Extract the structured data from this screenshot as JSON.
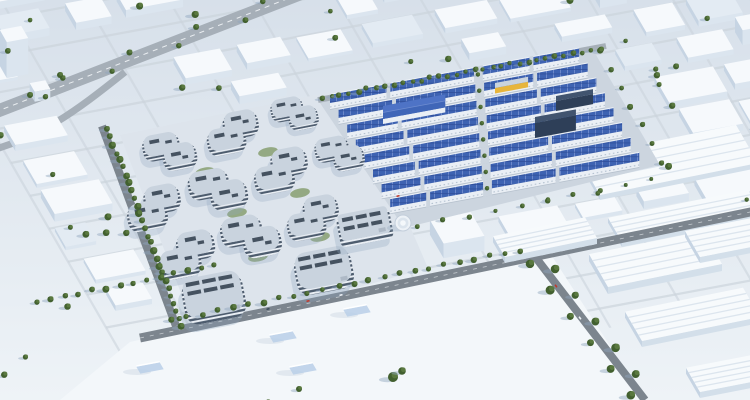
{
  "scene": {
    "label": "Aerial architectural rendering of a business and industrial park: curved terraced office buildings and rows of warehouses with blue rooftop solar panels, surrounded by white low-rise city massing and tree-lined roads",
    "type": "aerial-architectural-rendering",
    "office_campus": {
      "curved_buildings": 10,
      "tower_buildings": 2,
      "slab_buildings": 1,
      "feature": "curved stepped facades with rooftop solar panels"
    },
    "industrial_park": {
      "warehouse_rows": 8,
      "roof_type": "blue photovoltaic panels",
      "landmarks": [
        "large-blue-gable-hall",
        "navy-tower",
        "yellow-facade-unit",
        "round-pavilion"
      ]
    },
    "context": {
      "city_blocks": "white massing model",
      "roads": [
        "elevated-highway-northwest",
        "perimeter-roads",
        "tree-lined-avenue-southeast"
      ],
      "vegetation": "street trees and hedges"
    },
    "colors": {
      "bg_top": "#d7e0ea",
      "bg_bottom": "#eef3f7",
      "street": "#ccd4dc",
      "road_major": "#a6afb8",
      "road_dark": "#7c858e",
      "road_line": "#f2f5f8",
      "block_top": "#f6f9fc",
      "block_top_alt": "#e3ebf3",
      "block_front": "#dbe5ef",
      "block_side": "#c6d4e3",
      "tree_dark": "#42602f",
      "tree_light": "#5d7c42",
      "shadow": "#8fa5bd",
      "campus_ground": "#dde4ec",
      "facade_dark": "#4d5c6e",
      "facade_light": "#e9eef4",
      "roof_light": "#c9d3de",
      "panel_dark": "#2e3b4a",
      "park_ground": "#ccd5df",
      "wall_white": "#eaeff5",
      "solar_blue": "#3e63b2",
      "solar_line_v": "#7d97d4",
      "solar_line_h": "#2d4c97",
      "navy": "#2e3f58",
      "navy_roof": "#41546f",
      "yellow": "#e7b53c",
      "roof_blue_big": "#4066b8",
      "lot": "#f3f7fa",
      "pad_blue": "#b9cfe7",
      "shed_top": "#f7fafc",
      "shed_front": "#d3dfea",
      "shed_line": "#dce5ee",
      "grass": "#7b9660",
      "car_red": "#c0392b",
      "car_dark": "#3a4a5a",
      "car_white": "#eef2f6"
    }
  }
}
